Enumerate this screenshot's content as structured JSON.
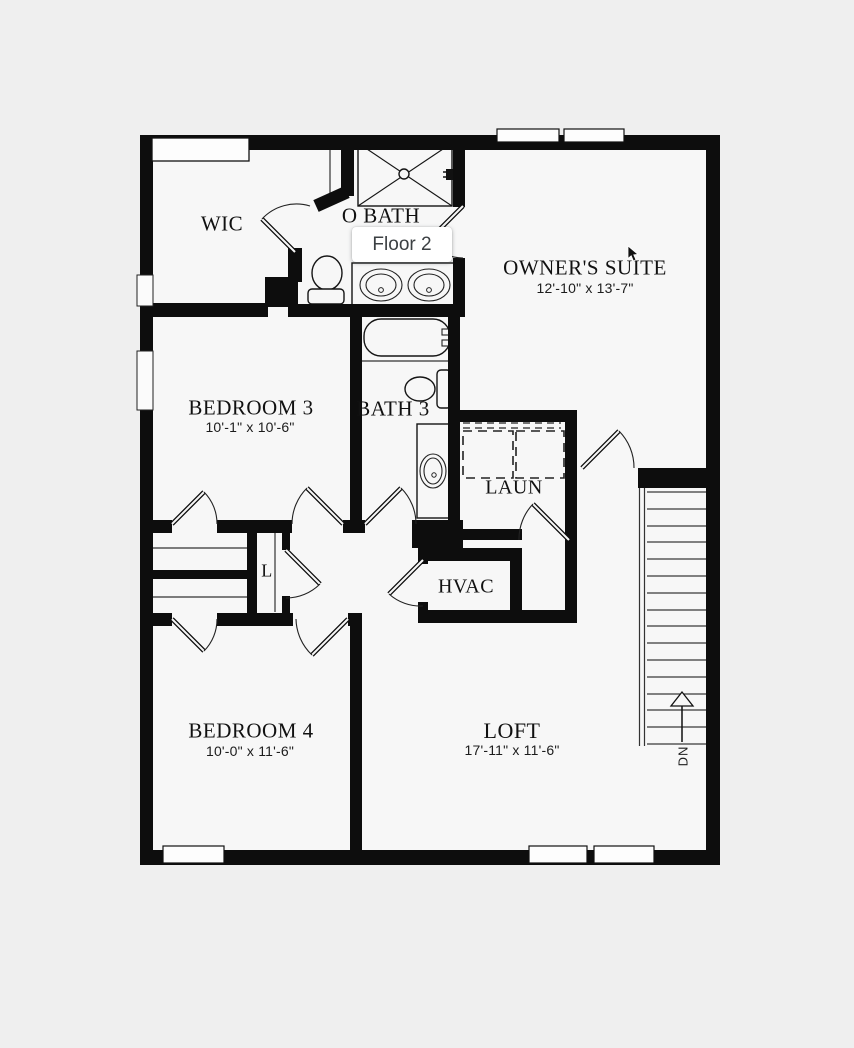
{
  "floor_selector": {
    "label": "Floor 2"
  },
  "rooms": {
    "wic": {
      "label": "WIC"
    },
    "o_bath": {
      "label": "O BATH"
    },
    "owners_suite": {
      "label": "OWNER'S SUITE",
      "dims": "12'-10\" x 13'-7\""
    },
    "bedroom_3": {
      "label": "BEDROOM 3",
      "dims": "10'-1\" x 10'-6\""
    },
    "bath_3": {
      "label": "BATH 3"
    },
    "laundry": {
      "label": "LAUN"
    },
    "linen_closet": {
      "label": "L"
    },
    "hvac": {
      "label": "HVAC"
    },
    "bedroom_4": {
      "label": "BEDROOM 4",
      "dims": "10'-0\" x 11'-6\""
    },
    "loft": {
      "label": "LOFT",
      "dims": "17'-11\" x 11'-6\""
    },
    "stairs": {
      "label": "DN"
    }
  },
  "colors": {
    "wall": "#0d0d0d",
    "background": "#efefef",
    "floor": "#f7f7f7",
    "chip_background": "#ffffff",
    "chip_text": "#3c4043"
  }
}
